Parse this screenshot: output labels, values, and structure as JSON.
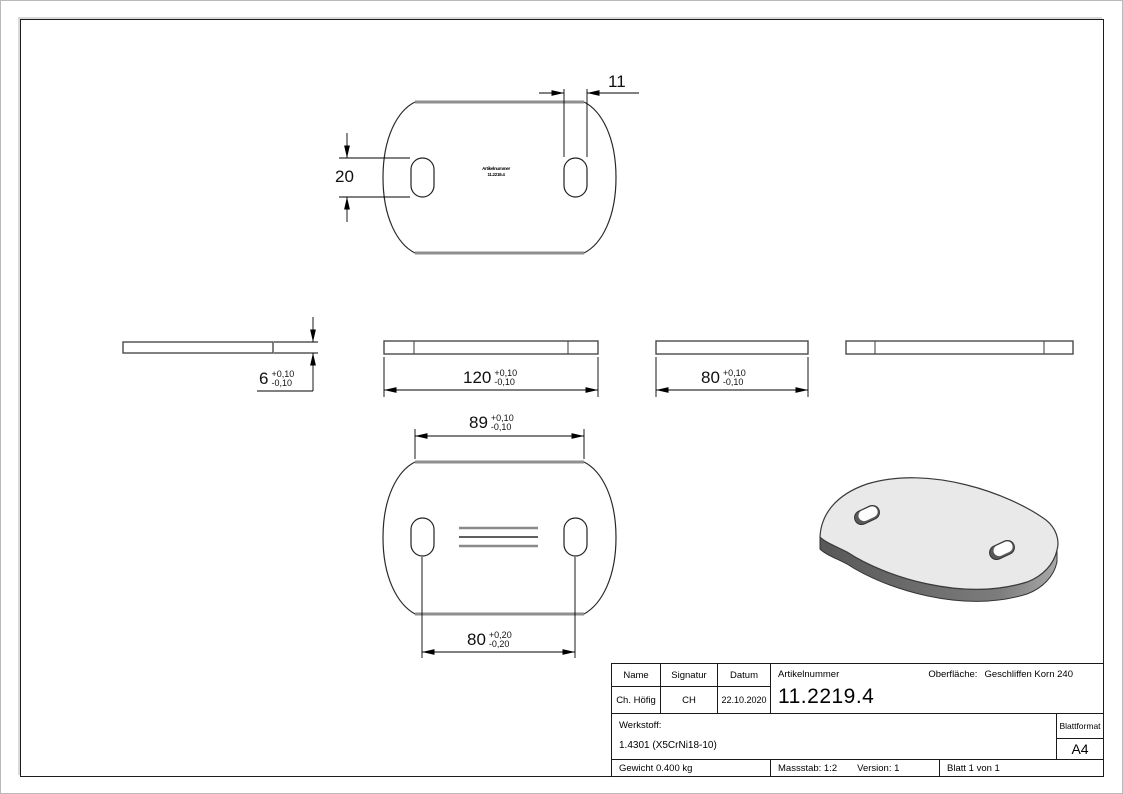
{
  "views": {
    "top": {
      "dims": {
        "slot_height": "20",
        "slot_width": "11"
      },
      "marking": {
        "line1": "Artikelnummer",
        "line2": "11.2219.4"
      }
    },
    "sections": {
      "thickness": {
        "v": "6",
        "tp": "+0,10",
        "tm": "-0,10"
      },
      "length": {
        "v": "120",
        "tp": "+0,10",
        "tm": "-0,10"
      },
      "width": {
        "v": "80",
        "tp": "+0,10",
        "tm": "-0,10"
      }
    },
    "bottom": {
      "flat_width": {
        "v": "89",
        "tp": "+0,10",
        "tm": "-0,10"
      },
      "slot_distance": {
        "v": "80",
        "tp": "+0,20",
        "tm": "-0,20"
      }
    }
  },
  "title_block": {
    "name_label": "Name",
    "signatur_label": "Signatur",
    "datum_label": "Datum",
    "name_value": "Ch. Höfig",
    "signatur_value": "CH",
    "datum_value": "22.10.2020",
    "artikelnummer_label": "Artikelnummer",
    "artikelnummer_value": "11.2219.4",
    "oberflaeche_label": "Oberfläche:",
    "oberflaeche_value": "Geschliffen Korn 240",
    "werkstoff_label": "Werkstoff:",
    "werkstoff_value": "1.4301 (X5CrNi18-10)",
    "blattformat_label": "Blattformat",
    "blattformat_value": "A4",
    "gewicht": "Gewicht 0.400 kg",
    "massstab": "Massstab: 1:2",
    "version": "Version: 1",
    "blatt": "Blatt 1 von 1"
  },
  "colors": {
    "line": "#1c1c1c",
    "flat_edge_gray": "#8f8f8f",
    "iso_top": "#e9e9e9",
    "iso_edge_dark": "#5f5f5f"
  }
}
